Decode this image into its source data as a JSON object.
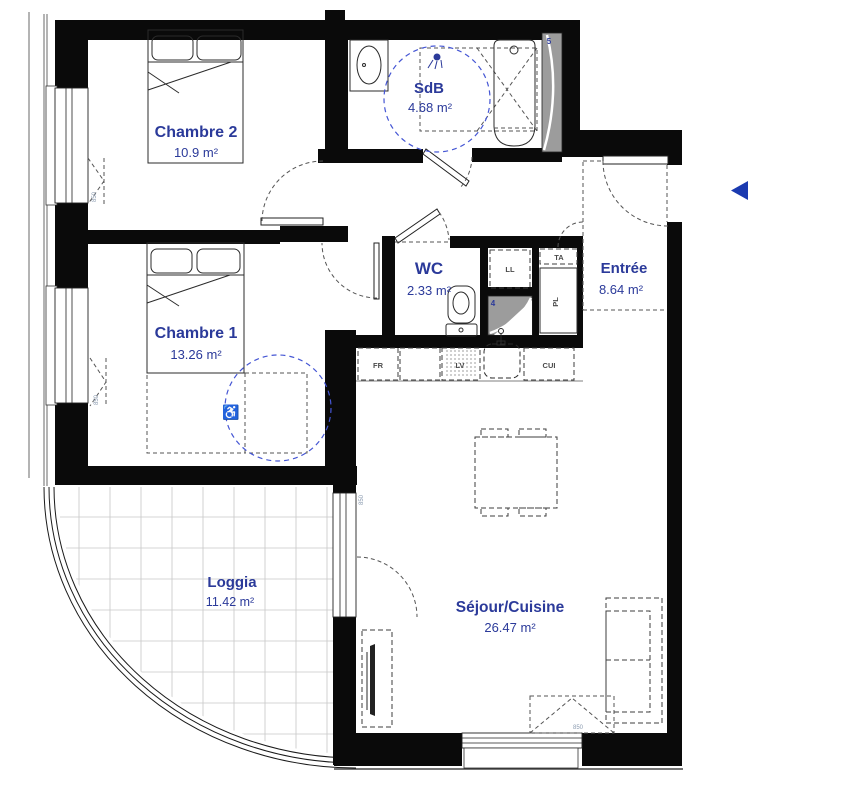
{
  "plan": {
    "rooms": [
      {
        "name": "Chambre 2",
        "area": "10.9 m²"
      },
      {
        "name": "SdB",
        "area": "4.68 m²"
      },
      {
        "name": "Entrée",
        "area": "8.64 m²"
      },
      {
        "name": "Chambre 1",
        "area": "13.26 m²"
      },
      {
        "name": "WC",
        "area": "2.33 m²"
      },
      {
        "name": "Séjour/Cuisine",
        "area": "26.47 m²"
      },
      {
        "name": "Loggia",
        "area": "11.42 m²"
      }
    ],
    "fixtures": {
      "washing_machine": "LL",
      "technical_panel": "TA",
      "closet": "PL",
      "fridge": "FR",
      "dishwasher": "LV",
      "cooktop": "CUI"
    },
    "shafts": {
      "duct_4": "4",
      "duct_5": "5"
    },
    "dimensions": {
      "sill_height": "850"
    },
    "icons": {
      "wheelchair": "♿"
    },
    "colors": {
      "label_blue": "#2b3a9a",
      "accessibility_blue": "#4556d4",
      "entrance_arrow_blue": "#1b3ab0",
      "wall_black": "#0a0a0a",
      "shaft_gray": "#9c9c9c"
    }
  }
}
